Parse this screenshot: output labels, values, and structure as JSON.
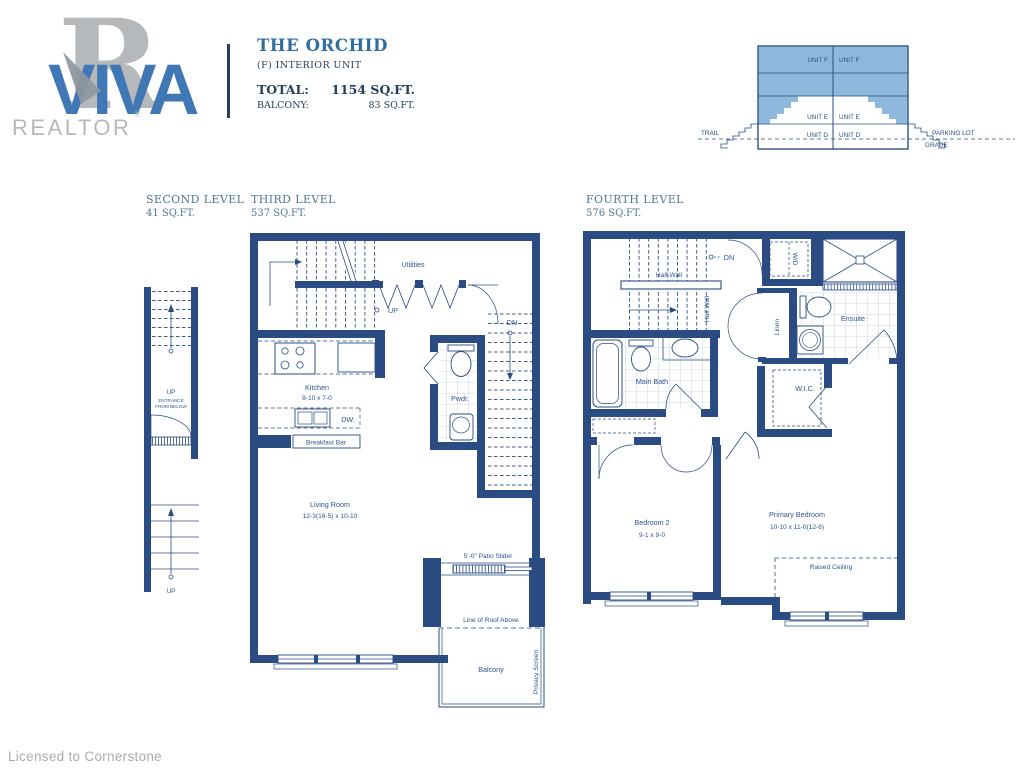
{
  "header": {
    "logo": {
      "r": "R",
      "brand": "VIVA",
      "realtor": "REALTOR",
      "registered": "®"
    },
    "title": "THE ORCHID",
    "subtitle": "(F) INTERIOR UNIT",
    "total_label": "TOTAL:",
    "total_value": "1154 SQ.FT.",
    "balcony_label": "BALCONY:",
    "balcony_value": "83 SQ.FT."
  },
  "cross_section": {
    "unit_f_left": "UNIT F",
    "unit_f_right": "UNIT F",
    "unit_e_left": "UNIT E",
    "unit_e_right": "UNIT E",
    "unit_d_left": "UNIT D",
    "unit_d_right": "UNIT D",
    "trail": "TRAIL",
    "parking_lot": "PARKING LOT",
    "grade": "GRADE"
  },
  "levels": {
    "second": {
      "name": "SECOND LEVEL",
      "area": "41 SQ.FT.",
      "labels": {
        "up_top": "UP",
        "entrance1": "ENTRANCE",
        "entrance2": "FROM BELOW",
        "up_bottom": "UP"
      }
    },
    "third": {
      "name": "THIRD LEVEL",
      "area": "537 SQ.FT.",
      "labels": {
        "utilities": "Utilities",
        "up": "UP",
        "dn": "DN",
        "kitchen": "Kitchen",
        "kitchen_dims": "8-10 x 7-0",
        "dw": "DW.",
        "breakfast_bar": "Breakfast Bar",
        "pwdr": "Pwdr.",
        "living_room": "Living Room",
        "living_room_dims": "12-3(16-5) x 10-10",
        "patio_slider": "5'-0\" Patio Slider",
        "line_of_roof": "Line of Roof Above",
        "balcony": "Balcony",
        "privacy_screen": "Privacy  Screen"
      }
    },
    "fourth": {
      "name": "FOURTH LEVEL",
      "area": "576 SQ.FT.",
      "labels": {
        "dn": "DN",
        "half_wall_h": "Half Wall",
        "half_wall_v": "Half Wall",
        "wd": "W/D",
        "linen": "Linen",
        "ensuite": "Ensuite",
        "main_bath": "Main Bath",
        "wic": "W.I.C.",
        "bedroom2": "Bedroom 2",
        "bedroom2_dims": "9-1 x 9-0",
        "primary": "Primary Bedroom",
        "primary_dims": "10-10 x 11-0(12-6)",
        "raised_ceiling": "Raised Ceiling"
      }
    }
  },
  "footer": {
    "license": "Licensed to Cornerstone"
  },
  "colors": {
    "wall_navy": "#2A4C82",
    "label_navy": "#2E5492",
    "light_blue": "#8FB9DC",
    "title_blue": "#2F6DA0",
    "header_blue": "#4E7799",
    "logo_blue": "#4077B5",
    "logo_gray": "#B5B9BC",
    "footer_gray": "#A7ACB1",
    "dark_text": "#24405C"
  }
}
